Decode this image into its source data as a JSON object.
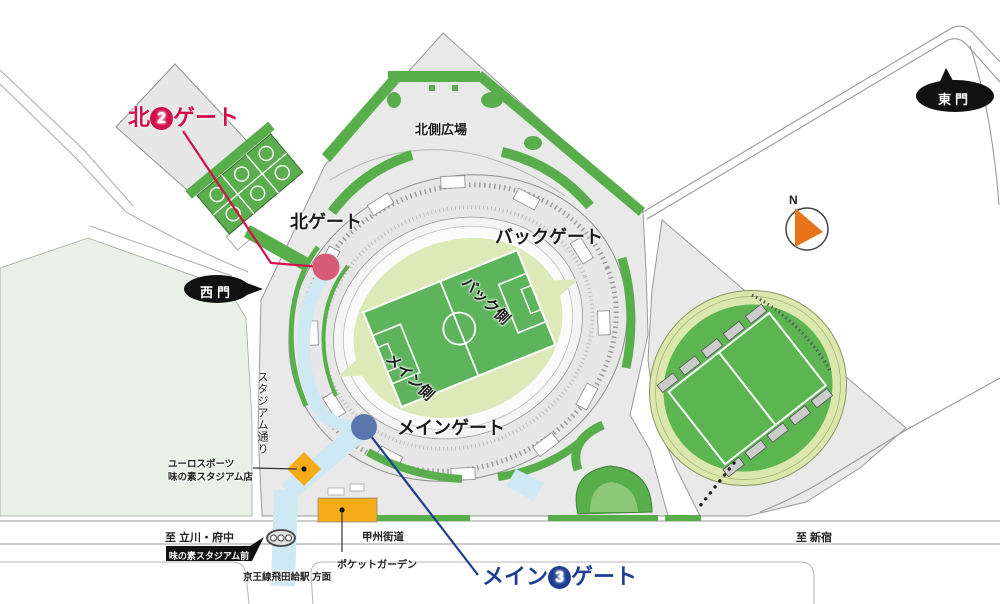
{
  "gates": {
    "north2": {
      "prefix": "北",
      "num": "2",
      "suffix": "ゲート"
    },
    "main3": {
      "prefix": "メイン",
      "num": "3",
      "suffix": "ゲート"
    },
    "north": "北ゲート",
    "back": "バックゲート",
    "main": "メインゲート",
    "west": "西門",
    "east": "東門"
  },
  "areas": {
    "north_plaza": "北側広場",
    "back_side": "バック側",
    "main_side": "メイン側"
  },
  "roads": {
    "stadium_street": "スタジアム通り",
    "koshu_kaido": "甲州街道",
    "to_tachikawa": "至 立川・府中",
    "to_shinjuku": "至 新宿",
    "keio_direction": "京王線飛田給駅 方面"
  },
  "places": {
    "euro_sports_line1": "ユーロスポーツ",
    "euro_sports_line2": "味の素スタジアム店",
    "pocket_garden": "ポケットガーデン",
    "bus_stop": "味の素スタジアム前"
  },
  "compass": {
    "north": "N"
  },
  "colors": {
    "gate2_red": "#d30f4b",
    "gate3_blue": "#1e3e92",
    "marker_red": "#d65c77",
    "marker_blue": "#5b76ae",
    "walkway_blue": "#cfe9f4",
    "green": "#57ae4b",
    "pitch_green": "#5eb45c",
    "field_light": "#dde9b8",
    "orange": "#f6ac19",
    "compass_orange": "#e8731a"
  }
}
